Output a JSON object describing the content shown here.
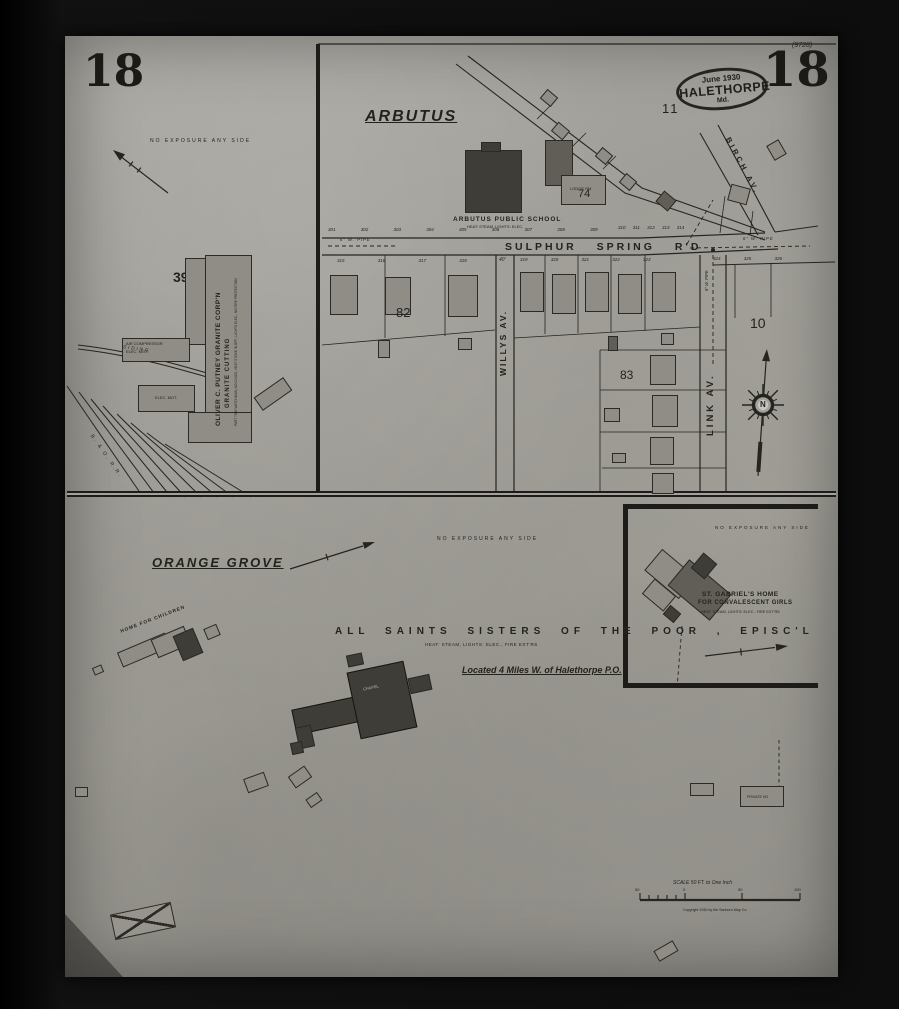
{
  "colors": {
    "paper": "#a3a19b",
    "ink": "#24221d",
    "building_gray": "#8f8d85",
    "building_dark": "#3f3d37"
  },
  "sheet": {
    "page_number": "18",
    "corner_note": "(9728)",
    "stamp": {
      "date": "June 1930",
      "city": "HALETHORPE",
      "state": "Md."
    }
  },
  "granite_panel": {
    "exposure_note": "NO EXPOSURE ANY SIDE",
    "block_number": "39",
    "factory": {
      "name_line1": "OLIVER C. PUTNEY GRANITE CORP'N",
      "name_line2": "GRANITE CUTTING",
      "note": "PART TIME WATCHMAN, NO CLOCK, HEAT STOVE IN OFF., LIGHTS ELEC., NO FIRE PROTECTION",
      "air_compressor_label": "AIR COMPRESSOR",
      "elec_motor_label": "ELEC. MOT."
    },
    "siding_label": "SIDING",
    "railroad_label": "B. & O. R.R."
  },
  "arbutus_panel": {
    "title": "ARBUTUS",
    "blocks": {
      "b11": "11",
      "b74": "74",
      "b82": "82",
      "b83": "83",
      "b10": "10"
    },
    "school": {
      "name": "ARBUTUS PUBLIC SCHOOL",
      "note": "HEAT: STEAM,  LIGHTS: ELEC."
    },
    "lodge_label": "LODGE RM.",
    "streets": {
      "sulphur_spring": "SULPHUR SPRING R'D",
      "willys": "WILLYS AV.",
      "link": "LINK AV.",
      "birch": "BIRCH AV.",
      "width_note": "40'",
      "pipe_note": "6\" W. PIPE"
    },
    "lots": {
      "north_west": "301 302 303 304 305 306 307 308 309",
      "north_east": "310 311 312 313 314",
      "south_west": "315 316 317 318",
      "south_mid": "319 320 321 322 323",
      "south_east": "324 325 326"
    }
  },
  "orange_grove_panel": {
    "title": "ORANGE GROVE",
    "exposure_note": "NO EXPOSURE ANY SIDE",
    "home_for_children_label": "HOME FOR CHILDREN",
    "caption": "ALL SAINTS SISTERS OF THE POOR , EPISC'L",
    "caption_note": "HEAT: STEAM,   LIGHTS: ELEC.,   FIRE EXT'RS",
    "location_note": "Located 4 Miles W. of Halethorpe P.O.",
    "chapel_label": "CHAPEL",
    "private_label": "PRIVATE HO.",
    "scale": {
      "label": "SCALE  50 FT. to One Inch",
      "n_left": "50",
      "n_zero": "0",
      "n_mid": "50",
      "n_right": "100",
      "copyright": "Copyright 1930 by the Sanborn Map Co."
    }
  },
  "inset_panel": {
    "exposure_note": "NO EXPOSURE ANY SIDE",
    "name_line1": "ST. GABRIEL'S HOME",
    "name_line2": "FOR CONVALESCENT GIRLS",
    "note": "HEAT: STEAM,   LIGHTS: ELEC.,   FIRE EXT'RS"
  },
  "compass": {
    "north_label": "N"
  }
}
